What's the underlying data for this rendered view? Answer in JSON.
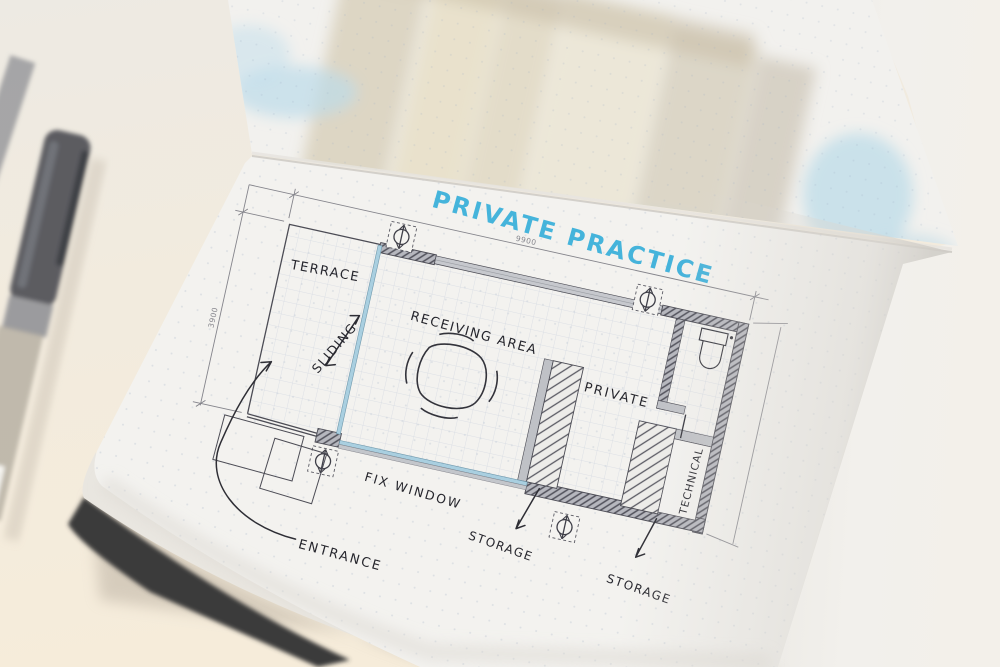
{
  "scene": {
    "description": "Photo of an open dot-grid notebook with a hand-drawn architectural floor plan sketch, a pen lying at the left edge and a watercolor sketch on the page above"
  },
  "title": {
    "text": "PRIVATE PRACTICE",
    "color": "#3cb0da"
  },
  "plan": {
    "rooms": [
      {
        "name": "TERRACE"
      },
      {
        "name": "RECEIVING AREA"
      },
      {
        "name": "PRIVATE"
      },
      {
        "name": "TECHNICAL"
      }
    ],
    "annotations": {
      "sliding": "SLIDING",
      "fix_window": "FIX WINDOW",
      "entrance": "ENTRANCE",
      "storage_front": "STORAGE",
      "storage_back": "STORAGE"
    },
    "dimensions": {
      "width": "9900",
      "height": "3900"
    },
    "colors": {
      "ink": "#26262d",
      "pencil": "#55555c",
      "glazing_blue": "#a9cfe0",
      "marker_blue": "#3cb0da",
      "paper": "#f3f2ef"
    }
  }
}
